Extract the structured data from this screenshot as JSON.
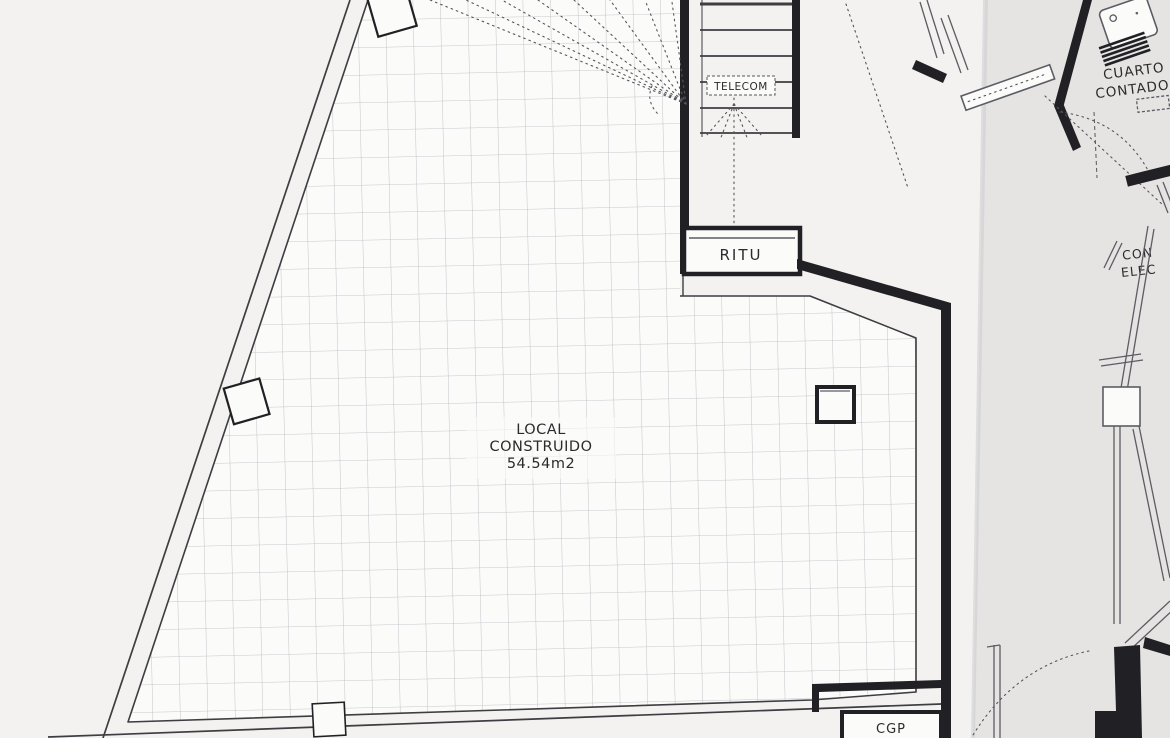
{
  "plan": {
    "labels": {
      "telecom": "TELECOM",
      "ritu": "RITU",
      "local_line1": "LOCAL",
      "local_line2": "CONSTRUIDO",
      "local_area": "54.54m2",
      "cgp": "CGP",
      "meter_room_line1": "CUARTO E",
      "meter_room_line2": "CONTADORE",
      "elec_line1": "CON",
      "elec_line2": "ELEC"
    },
    "colors": {
      "paper": "#f3f2f0",
      "paper-shade": "#e8e8eb",
      "wall": "#212125",
      "line": "#3d3d42",
      "annex": "#5c5c64",
      "grid": "#b7b7c0",
      "dotted": "#55555e",
      "ink": "#2b2b2e",
      "fill": "#fbfbfa"
    }
  }
}
